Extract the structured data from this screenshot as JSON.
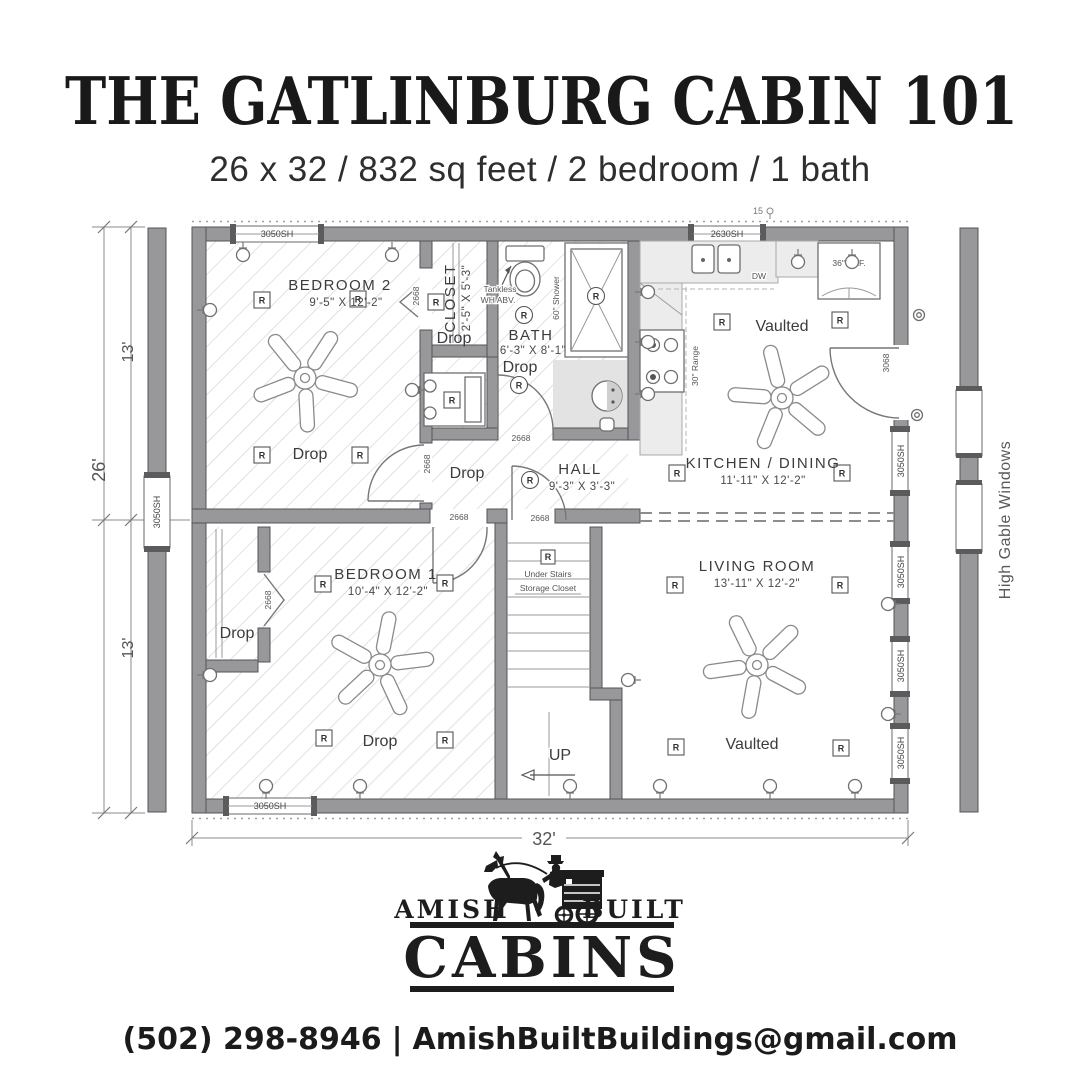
{
  "header": {
    "title": "THE GATLINBURG CABIN 101",
    "subtitle": "26 x 32 / 832 sq feet / 2 bedroom / 1 bath"
  },
  "plan": {
    "rooms": {
      "bedroom2": {
        "name": "BEDROOM 2",
        "dims": "9'-5\" X 12'-2\""
      },
      "closet": {
        "name": "CLOSET",
        "dims": "2'-5\" X 5'-3\""
      },
      "bath": {
        "name": "BATH",
        "dims": "6'-3\" X 8'-1\""
      },
      "hall": {
        "name": "HALL",
        "dims": "9'-3\" X 3'-3\""
      },
      "kitchen": {
        "name": "KITCHEN / DINING",
        "dims": "11'-11\" X 12'-2\""
      },
      "bedroom1": {
        "name": "BEDROOM 1",
        "dims": "10'-4\" X 12'-2\""
      },
      "living": {
        "name": "LIVING ROOM",
        "dims": "13'-11\" X 12'-2\""
      }
    },
    "labels": {
      "drop": "Drop",
      "vaulted": "Vaulted",
      "up": "UP",
      "under_stairs_1": "Under Stairs",
      "under_stairs_2": "Storage Closet",
      "tankless_1": "Tankless",
      "tankless_2": "WH ABV.",
      "shower": "60\" Shower",
      "range": "30\" Range",
      "fridge": "36\" REF.",
      "dw": "DW",
      "recessed": "R",
      "note_top": "15",
      "high_gable": "High Gable Windows"
    },
    "openings": {
      "window_3050": "3050SH",
      "window_2630": "2630SH",
      "door_2668": "2668",
      "door_3068": "3068"
    },
    "dimensions": {
      "total_height": "26'",
      "half_height_top": "13'",
      "half_height_bottom": "13'",
      "total_width": "32'"
    }
  },
  "footer": {
    "logo_left": "AMISH",
    "logo_right": "BUILT",
    "logo_main": "CABINS",
    "phone": "(502) 298-8946",
    "separator": "|",
    "email": "AmishBuiltBuildings@gmail.com"
  }
}
